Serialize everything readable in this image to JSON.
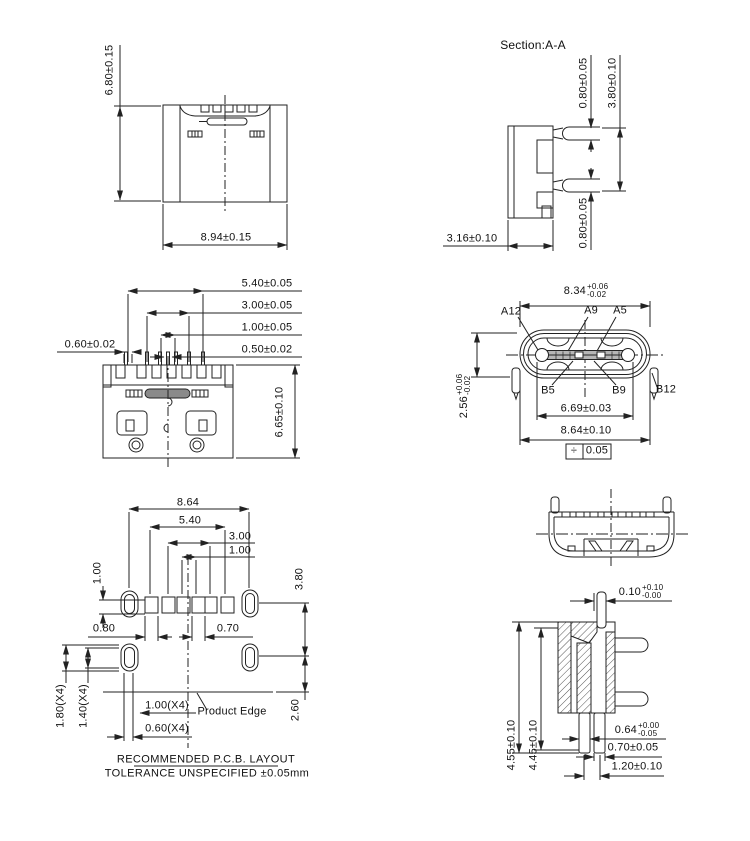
{
  "drawing": {
    "views": {
      "front": {
        "height": "6.80±0.15",
        "width": "8.94±0.15"
      },
      "section": {
        "title": "Section:A-A",
        "pin_thickness_top": "0.80±0.05",
        "pin_spacing": "3.80±0.10",
        "depth": "3.16±0.10",
        "pin_thickness_bottom": "0.80±0.05"
      },
      "top": {
        "pitch_540": "5.40±0.05",
        "pitch_300": "3.00±0.05",
        "pitch_100": "1.00±0.05",
        "pitch_050": "0.50±0.02",
        "pin_width": "0.60±0.02",
        "depth": "6.65±0.10"
      },
      "face": {
        "width_inner": {
          "value": "8.34",
          "plus": "+0.06",
          "minus": "-0.02"
        },
        "height": {
          "value": "2.56",
          "plus": "+0.06",
          "minus": "-0.02"
        },
        "pins": {
          "a12": "A12",
          "a9": "A9",
          "a5": "A5",
          "b5": "B5",
          "b9": "B9",
          "b12": "B12"
        },
        "tongue_width": "6.69±0.03",
        "width_outer": "8.64±0.10",
        "flatness": {
          "symbol": "÷",
          "value": "0.05"
        }
      },
      "pcb": {
        "span_864": "8.64",
        "span_540": "5.40",
        "span_300": "3.00",
        "span_100": "1.00",
        "pad_height": "1.00",
        "row_spacing": "3.80",
        "pad_080": "0.80",
        "pad_070": "0.70",
        "slot_180": "1.80(X4)",
        "slot_140": "1.40(X4)",
        "slot_100": "1.00(X4)",
        "product_edge": "Product Edge",
        "slot_060": "0.60(X4)",
        "edge_260": "2.60",
        "note_title": "RECOMMENDED   P.C.B.  LAYOUT",
        "note_tolerance": "TOLERANCE  UNSPECIFIED  ±0.05mm"
      },
      "side": {
        "gap": {
          "value": "0.10",
          "plus": "+0.10",
          "minus": "-0.00"
        },
        "height_455": "4.55±0.10",
        "height_445": "4.45±0.10",
        "leg_064": {
          "value": "0.64",
          "plus": "+0.00",
          "minus": "-0.05"
        },
        "leg_070": "0.70±0.05",
        "leg_120": "1.20±0.10"
      }
    }
  }
}
